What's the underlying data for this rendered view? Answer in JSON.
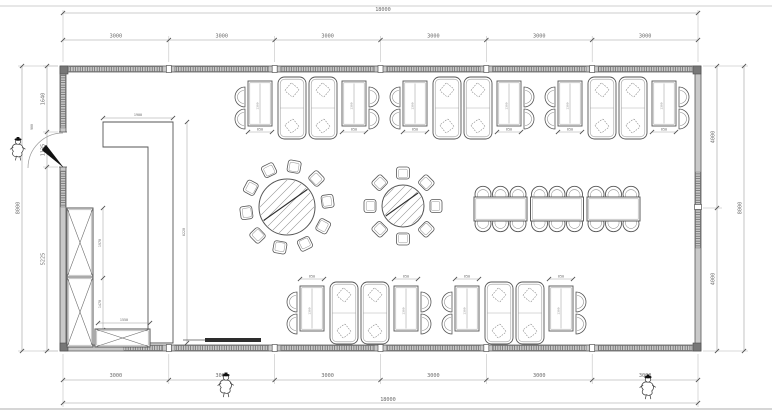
{
  "sheet": {
    "bg": "#ffffff",
    "ink": "#565656",
    "light_ink": "#9a9a9a",
    "dim_ink": "#8f8f8f",
    "text_ink": "#6a6a6a",
    "wall_fill": "#c9c9c9",
    "dark": "#111111"
  },
  "dimensions": {
    "top": {
      "total": "18000",
      "segments": [
        "3000",
        "3000",
        "3000",
        "3000",
        "3000",
        "3000"
      ]
    },
    "bottom": {
      "total": "18000",
      "segments": [
        "3000",
        "3000",
        "3000",
        "3000",
        "3000",
        "3000"
      ]
    },
    "left": {
      "total": "8000",
      "segments": [
        "1640",
        "1135",
        "5225"
      ]
    },
    "right": {
      "total": "8000",
      "segments": [
        "4000",
        "4000"
      ]
    },
    "door_width": "900",
    "booth": {
      "table_width": "650",
      "table_depth": "1300"
    },
    "counter": {
      "top_width": "1900",
      "length": "6220",
      "seg_a": "1970",
      "seg_b": "1470",
      "base_width": "1550"
    }
  },
  "furniture": {
    "booth_groups": [
      {
        "x": 233,
        "y": 77,
        "label_side": "below"
      },
      {
        "x": 388,
        "y": 77,
        "label_side": "below"
      },
      {
        "x": 543,
        "y": 77,
        "label_side": "below"
      },
      {
        "x": 285,
        "y": 282,
        "label_side": "above"
      },
      {
        "x": 440,
        "y": 282,
        "label_side": "above"
      }
    ],
    "round_tables": [
      {
        "cx": 287,
        "cy": 207,
        "table_r": 28,
        "chairs": 10,
        "ring_r": 41,
        "start_deg": 10
      },
      {
        "cx": 403,
        "cy": 206,
        "table_r": 21,
        "chairs": 8,
        "ring_r": 33,
        "start_deg": 0
      }
    ],
    "banquet": {
      "x": 474,
      "y": 197,
      "tables": 3,
      "table_w": 53,
      "table_h": 24,
      "gap": 3.5,
      "chairs_per_side": 3
    },
    "counter_shape": {
      "x1": 103,
      "x2": 173,
      "inner_x": 148,
      "top_y": 122,
      "shelf_y": 147,
      "bottom_y": 343
    },
    "cabinets": [
      {
        "x": 67,
        "y": 208,
        "w": 26,
        "h": 69
      },
      {
        "x": 67,
        "y": 277,
        "w": 26,
        "h": 70
      },
      {
        "x": 95,
        "y": 329,
        "w": 55,
        "h": 18
      }
    ],
    "bottom_door_leaf": {
      "x": 205,
      "y": 338,
      "w": 56,
      "h": 4
    }
  },
  "persons": [
    {
      "x": 18,
      "y": 146,
      "s": 1.0
    },
    {
      "x": 226,
      "y": 382,
      "s": 1.05
    },
    {
      "x": 648,
      "y": 384,
      "s": 1.05
    }
  ]
}
